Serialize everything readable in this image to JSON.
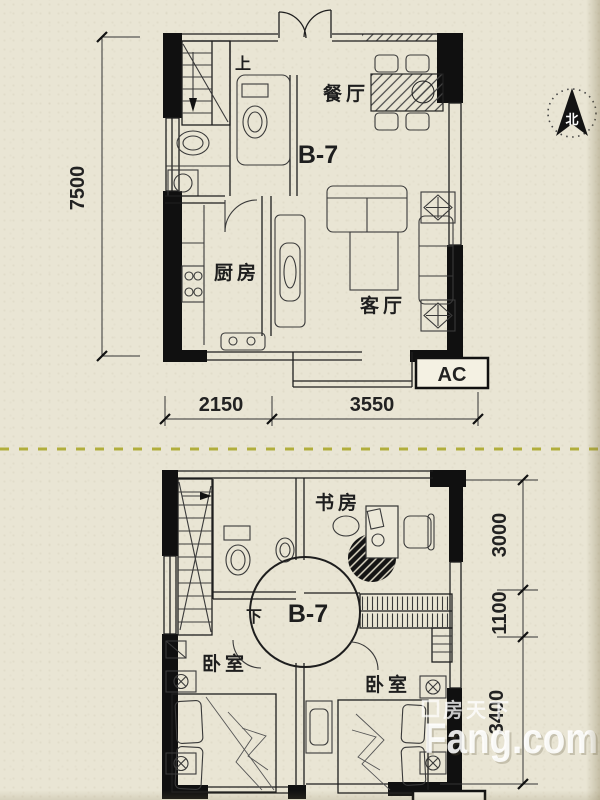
{
  "floor1": {
    "unit_label": "B-7",
    "rooms": {
      "dining": "餐厅",
      "kitchen": "厨房",
      "living": "客厅"
    },
    "stair_label": "上",
    "ac_label": "AC",
    "dimensions": {
      "left_height": "7500",
      "bottom_left": "2150",
      "bottom_right": "3550"
    }
  },
  "floor2": {
    "unit_label": "B-7",
    "rooms": {
      "study": "书房",
      "bedroom_left": "卧室",
      "bedroom_right": "卧室"
    },
    "stair_label": "下",
    "ac_label": "AC",
    "dimensions": {
      "right_top": "3000",
      "right_middle": "1100",
      "right_bottom": "3400"
    }
  },
  "compass": {
    "north_label": "北"
  },
  "watermark": {
    "site_cn": "房天下",
    "site_en": "Fang.com"
  },
  "colors": {
    "paper": "#e9e5d4",
    "ink": "#1e1e1e",
    "wall": "#101010",
    "separator": "#b1ae3c",
    "ac_bg": "#f4f1e3",
    "watermark": "#ffffff"
  }
}
